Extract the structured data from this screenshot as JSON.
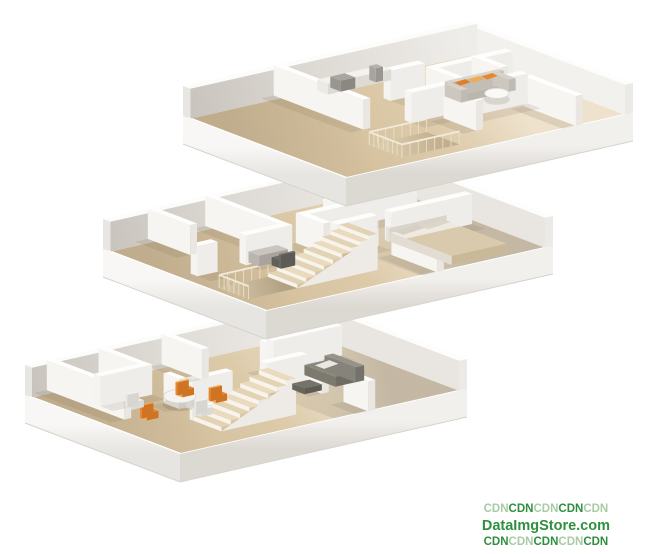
{
  "watermark": {
    "line1": [
      {
        "text": "CDN",
        "tone": "light"
      },
      {
        "text": "CDN",
        "tone": "dark"
      },
      {
        "text": "CDN",
        "tone": "light"
      },
      {
        "text": "CDN",
        "tone": "dark"
      },
      {
        "text": "CDN",
        "tone": "light"
      }
    ],
    "line2": "DataImgStore.com",
    "line3": [
      {
        "text": "CDN",
        "tone": "dark"
      },
      {
        "text": "CDN",
        "tone": "light"
      },
      {
        "text": "CDN",
        "tone": "dark"
      },
      {
        "text": "CDN",
        "tone": "light"
      },
      {
        "text": "CDN",
        "tone": "dark"
      }
    ],
    "colors": {
      "dark": "#2f8f3f",
      "light": "#a8cba6"
    }
  },
  "scene": {
    "floors": [
      {
        "name": "upper-floor",
        "furniture": [
          "sofa",
          "coffee-table",
          "kitchen-counter",
          "stair-railing"
        ]
      },
      {
        "name": "middle-floor",
        "furniture": [
          "bed",
          "desk",
          "desk-chair",
          "staircase",
          "stair-railing"
        ]
      },
      {
        "name": "ground-floor",
        "furniture": [
          "dining-table",
          "dining-chairs",
          "sofa",
          "side-table",
          "staircase"
        ]
      }
    ],
    "palette": {
      "background": "#ffffff",
      "wall": "#ffffff",
      "wall_shade": "#e7e4df",
      "floor_wood": "#dccaa9",
      "floor_wood_light": "#eee2cc",
      "floor_wood_dark": "#d5c19e",
      "accent_orange": "#e8872f",
      "accent_orange_light": "#f4a951",
      "sofa_gray": "#d4cfc7",
      "dark_furniture": "#75736a",
      "bed_blanket": "#d9c9ad",
      "railing": "#e8dfc8"
    }
  }
}
